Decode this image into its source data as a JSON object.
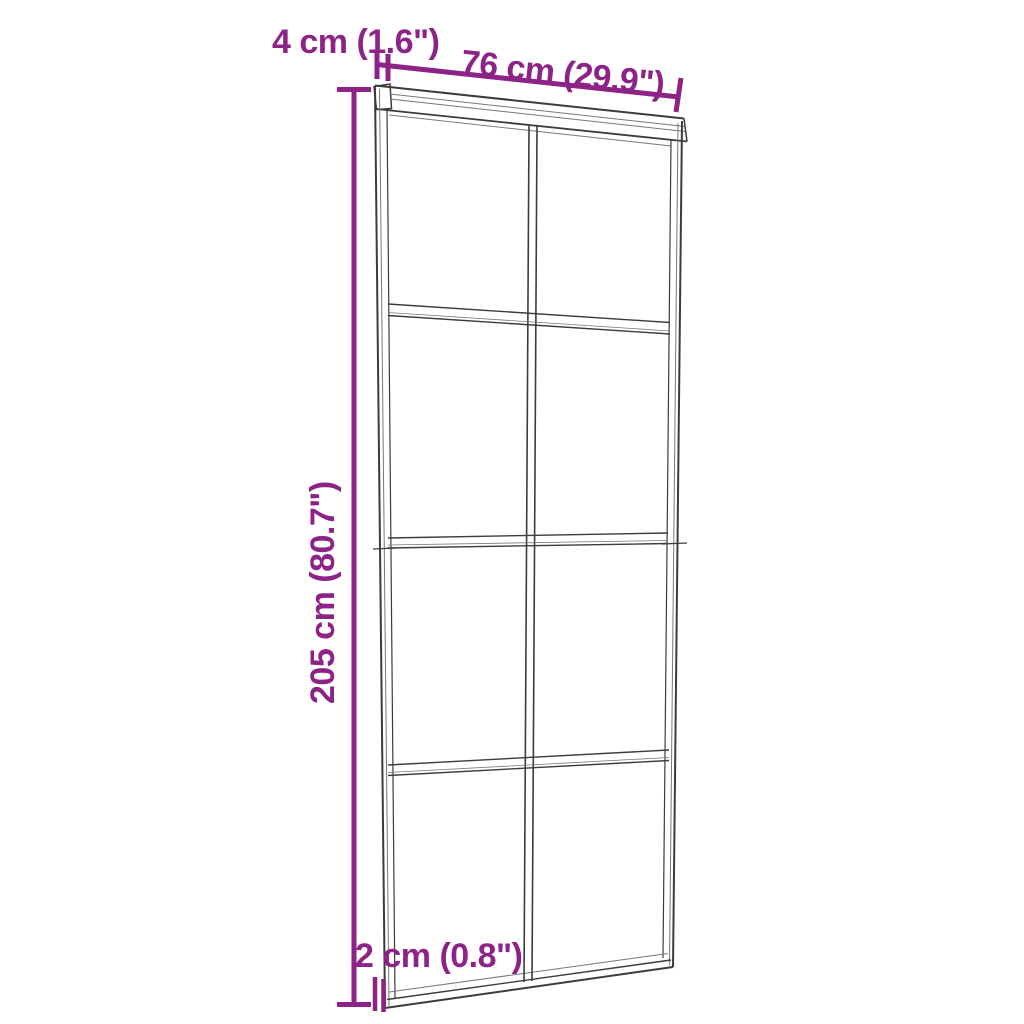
{
  "diagram": {
    "type": "product-dimension-diagram",
    "subject": "sliding glass door with 2x4 pane grid and top track",
    "background_color": "#ffffff",
    "accent_color": "#8d2287",
    "line_color": "#3c3c3c",
    "pane_grid": {
      "columns": 2,
      "rows": 4
    },
    "dimensions": {
      "track_width": {
        "label": "4 cm (1.6\")",
        "position": "top-left"
      },
      "door_width": {
        "label": "76 cm (29.9\")",
        "position": "top"
      },
      "door_height": {
        "label": "205 cm (80.7\")",
        "position": "left-vertical"
      },
      "door_thickness": {
        "label": "2 cm (0.8\")",
        "position": "bottom-left"
      }
    }
  }
}
